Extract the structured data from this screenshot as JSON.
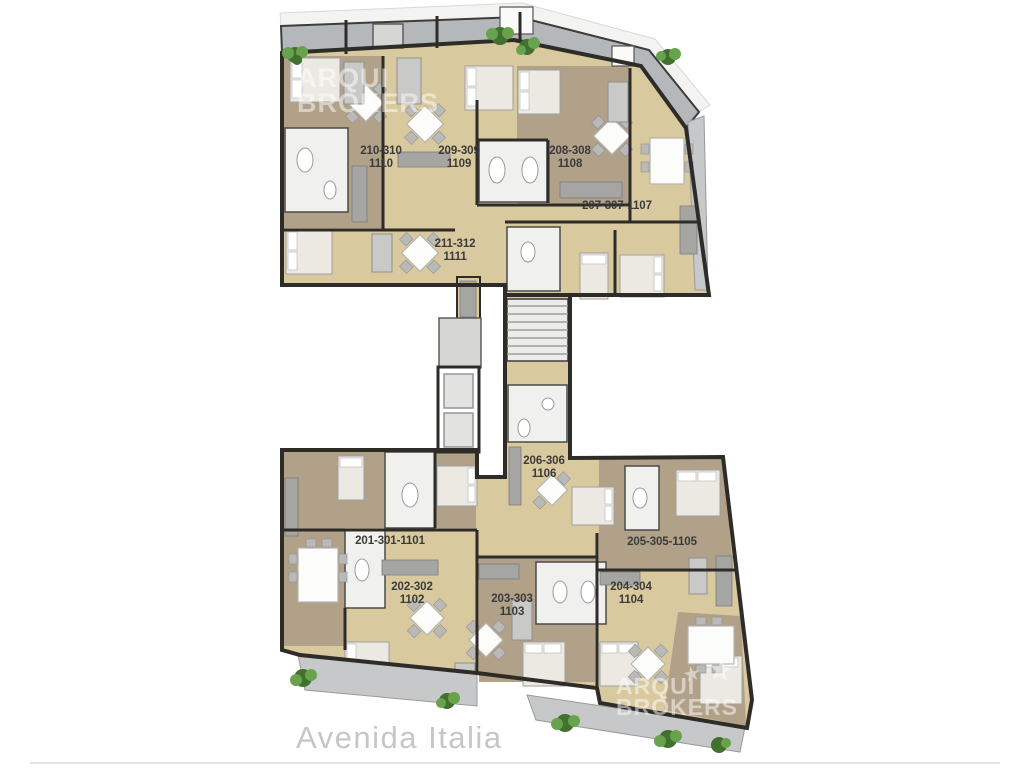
{
  "plan": {
    "street": {
      "label": "Avenida Italia"
    },
    "watermarks": {
      "top_left": {
        "line1": "ARQUI",
        "line2": "BROKERS"
      },
      "bottom_right": {
        "line1": "ARQUI",
        "line2": "BROKERS"
      },
      "star_icon": "★"
    },
    "units": [
      {
        "name": "unit-210-310",
        "line1": "210-310",
        "line2": "1110",
        "x": 381,
        "y": 145
      },
      {
        "name": "unit-209-309",
        "line1": "209-309",
        "line2": "1109",
        "x": 459,
        "y": 145
      },
      {
        "name": "unit-208-308",
        "line1": "208-308",
        "line2": "1108",
        "x": 570,
        "y": 145
      },
      {
        "name": "unit-207-307",
        "line1": "207-307-1107",
        "line2": "",
        "x": 617,
        "y": 200
      },
      {
        "name": "unit-211-312",
        "line1": "211-312",
        "line2": "1111",
        "x": 455,
        "y": 238
      },
      {
        "name": "unit-206-306",
        "line1": "206-306",
        "line2": "1106",
        "x": 544,
        "y": 455
      },
      {
        "name": "unit-201-301",
        "line1": "201-301-1101",
        "line2": "",
        "x": 390,
        "y": 535
      },
      {
        "name": "unit-205-305",
        "line1": "205-305-1105",
        "line2": "",
        "x": 662,
        "y": 536
      },
      {
        "name": "unit-202-302",
        "line1": "202-302",
        "line2": "1102",
        "x": 412,
        "y": 581
      },
      {
        "name": "unit-203-303",
        "line1": "203-303",
        "line2": "1103",
        "x": 512,
        "y": 593
      },
      {
        "name": "unit-204-304",
        "line1": "204-304",
        "line2": "1104",
        "x": 631,
        "y": 581
      }
    ],
    "colors": {
      "wall": "#2e2c29",
      "tan": "#d9c99e",
      "wood": "#b1a189",
      "tile": "#f0f0ee",
      "balc": "#b5b8ba",
      "balcl": "#c6c8c9",
      "sidewalk": "#f3f3f1",
      "counter": "#a5a5a3",
      "furn": "#ece9e2",
      "sofa": "#c9c9c7",
      "label": "#3b3b3b",
      "street": "#c6c6c6",
      "wm": "rgba(255,255,255,0.5)",
      "plantd": "#41702f",
      "plantl": "#69a24c"
    }
  }
}
